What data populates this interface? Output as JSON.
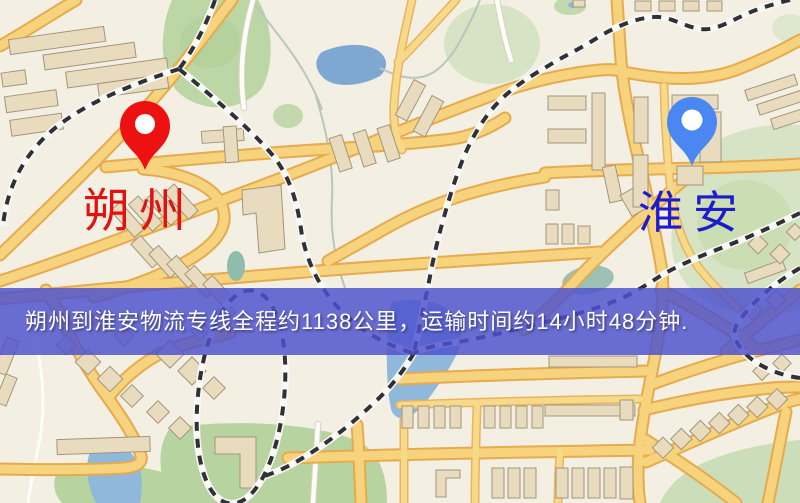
{
  "map": {
    "kind": "logistics-route-map",
    "origin": {
      "name": "朔州",
      "pin_color": "#ee1111",
      "label_color": "#e01212"
    },
    "destination": {
      "name": "淮安",
      "pin_color": "#4b87f2",
      "label_color": "#1c1ccc"
    },
    "banner": {
      "text": "朔州到淮安物流专线全程约1138公里，运输时间约14小时48分钟.",
      "distance_km": "1138",
      "duration": "14小时48分钟",
      "background_color": "#4d50ce",
      "text_color": "#ffffff"
    },
    "legend_colors": {
      "background": "#f3efe2",
      "major_road": "#f6d37c",
      "road_casing": "#e5ab4e",
      "water": "#8fb8da",
      "park": "#bcd6a6",
      "railway": "#303036",
      "building": "#e9dcbe"
    }
  }
}
